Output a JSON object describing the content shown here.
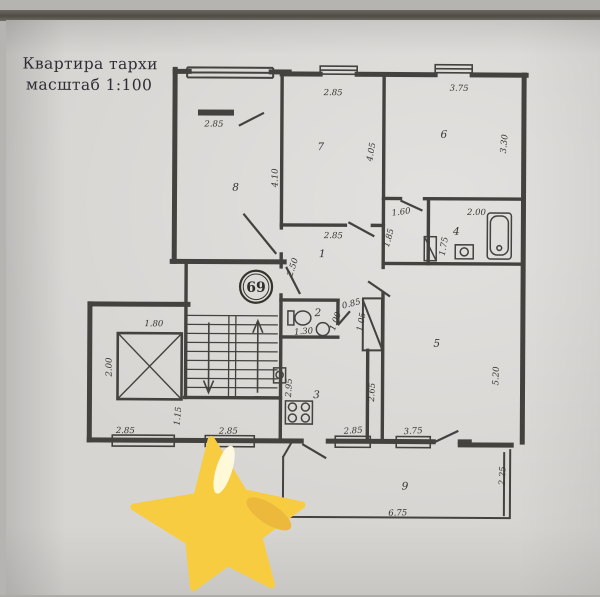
{
  "title": {
    "line1": "Квартира тархи",
    "line2": "масштаб 1:100"
  },
  "apartment_badge": "69",
  "plan": {
    "room_labels": [
      {
        "t": "1",
        "x": 322,
        "y": 257
      },
      {
        "t": "2",
        "x": 318,
        "y": 316
      },
      {
        "t": "3",
        "x": 317,
        "y": 398
      },
      {
        "t": "4",
        "x": 456,
        "y": 234
      },
      {
        "t": "5",
        "x": 437,
        "y": 346
      },
      {
        "t": "6",
        "x": 443,
        "y": 137
      },
      {
        "t": "7",
        "x": 320,
        "y": 150
      },
      {
        "t": "8",
        "x": 235,
        "y": 191
      },
      {
        "t": "9",
        "x": 406,
        "y": 489
      }
    ],
    "dimensions": [
      {
        "t": "2.85",
        "x": 213,
        "y": 127,
        "r": 0
      },
      {
        "t": "2.85",
        "x": 332,
        "y": 95,
        "r": 0
      },
      {
        "t": "3.75",
        "x": 458,
        "y": 90,
        "r": 0
      },
      {
        "t": "4.10",
        "x": 277,
        "y": 178,
        "r": -90
      },
      {
        "t": "4.05",
        "x": 373,
        "y": 152,
        "r": -80
      },
      {
        "t": "3.30",
        "x": 506,
        "y": 143,
        "r": -85
      },
      {
        "t": "1.60",
        "x": 401,
        "y": 214,
        "r": -8
      },
      {
        "t": "1.85",
        "x": 391,
        "y": 238,
        "r": -75
      },
      {
        "t": "2.00",
        "x": 476,
        "y": 214,
        "r": 0
      },
      {
        "t": "1.75",
        "x": 446,
        "y": 246,
        "r": -80
      },
      {
        "t": "2.85",
        "x": 333,
        "y": 238,
        "r": 0
      },
      {
        "t": "2.50",
        "x": 295,
        "y": 268,
        "r": -72
      },
      {
        "t": "1.80",
        "x": 154,
        "y": 327,
        "r": 0
      },
      {
        "t": "2.00",
        "x": 112,
        "y": 368,
        "r": -90
      },
      {
        "t": "0.85",
        "x": 352,
        "y": 306,
        "r": -15
      },
      {
        "t": "1.00",
        "x": 338,
        "y": 322,
        "r": -70
      },
      {
        "t": "1.05",
        "x": 364,
        "y": 322,
        "r": -80
      },
      {
        "t": "1.30",
        "x": 304,
        "y": 334,
        "r": -5
      },
      {
        "t": "1.15",
        "x": 181,
        "y": 417,
        "r": -85
      },
      {
        "t": "2.95",
        "x": 292,
        "y": 388,
        "r": -87
      },
      {
        "t": "2.65",
        "x": 375,
        "y": 392,
        "r": -87
      },
      {
        "t": "5.20",
        "x": 499,
        "y": 375,
        "r": -88
      },
      {
        "t": "2.85",
        "x": 126,
        "y": 434,
        "r": 0
      },
      {
        "t": "2.85",
        "x": 229,
        "y": 434,
        "r": 0
      },
      {
        "t": "2.85",
        "x": 354,
        "y": 433,
        "r": -4
      },
      {
        "t": "3.75",
        "x": 414,
        "y": 433,
        "r": -4
      },
      {
        "t": "6.75",
        "x": 399,
        "y": 515,
        "r": -2
      },
      {
        "t": "2.25",
        "x": 506,
        "y": 475,
        "r": -87
      }
    ]
  },
  "star_sticker": {
    "color": "#F8CC41",
    "highlight": "#FFFBE0",
    "shade": "#ECB93C"
  }
}
